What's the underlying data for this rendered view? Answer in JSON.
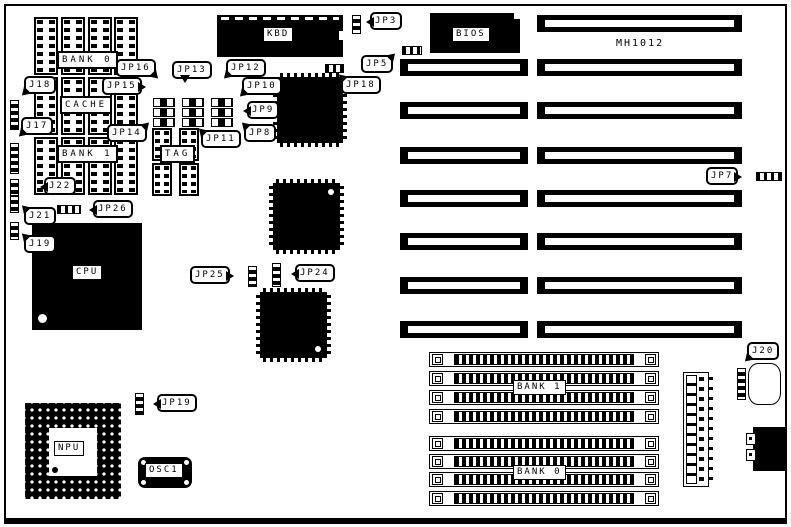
{
  "board": {
    "model": "MH1012"
  },
  "chip_labels": {
    "bank0_dip": "BANK 0",
    "cache": "CACHE",
    "bank1_dip": "BANK 1",
    "tag": "TAG",
    "kbd": "KBD",
    "bios": "BIOS",
    "cpu": "CPU",
    "npu": "NPU",
    "osc1": "OSC1",
    "bank1_simm": "BANK 1",
    "bank0_simm": "BANK 0"
  },
  "callouts": {
    "j18": "J18",
    "j17": "J17",
    "j22": "J22",
    "j21": "J21",
    "j19": "J19",
    "jp26": "JP26",
    "jp16": "JP16",
    "jp15": "JP15",
    "jp14": "JP14",
    "jp13": "JP13",
    "jp12": "JP12",
    "jp11": "JP11",
    "jp10": "JP10",
    "jp9": "JP9",
    "jp8": "JP8",
    "jp3": "JP3",
    "jp5": "JP5",
    "jp18": "JP18",
    "jp7": "JP7",
    "jp25": "JP25",
    "jp24": "JP24",
    "jp19": "JP19",
    "j20": "J20"
  },
  "colors": {
    "ink": "#000000",
    "paper": "#ffffff"
  }
}
